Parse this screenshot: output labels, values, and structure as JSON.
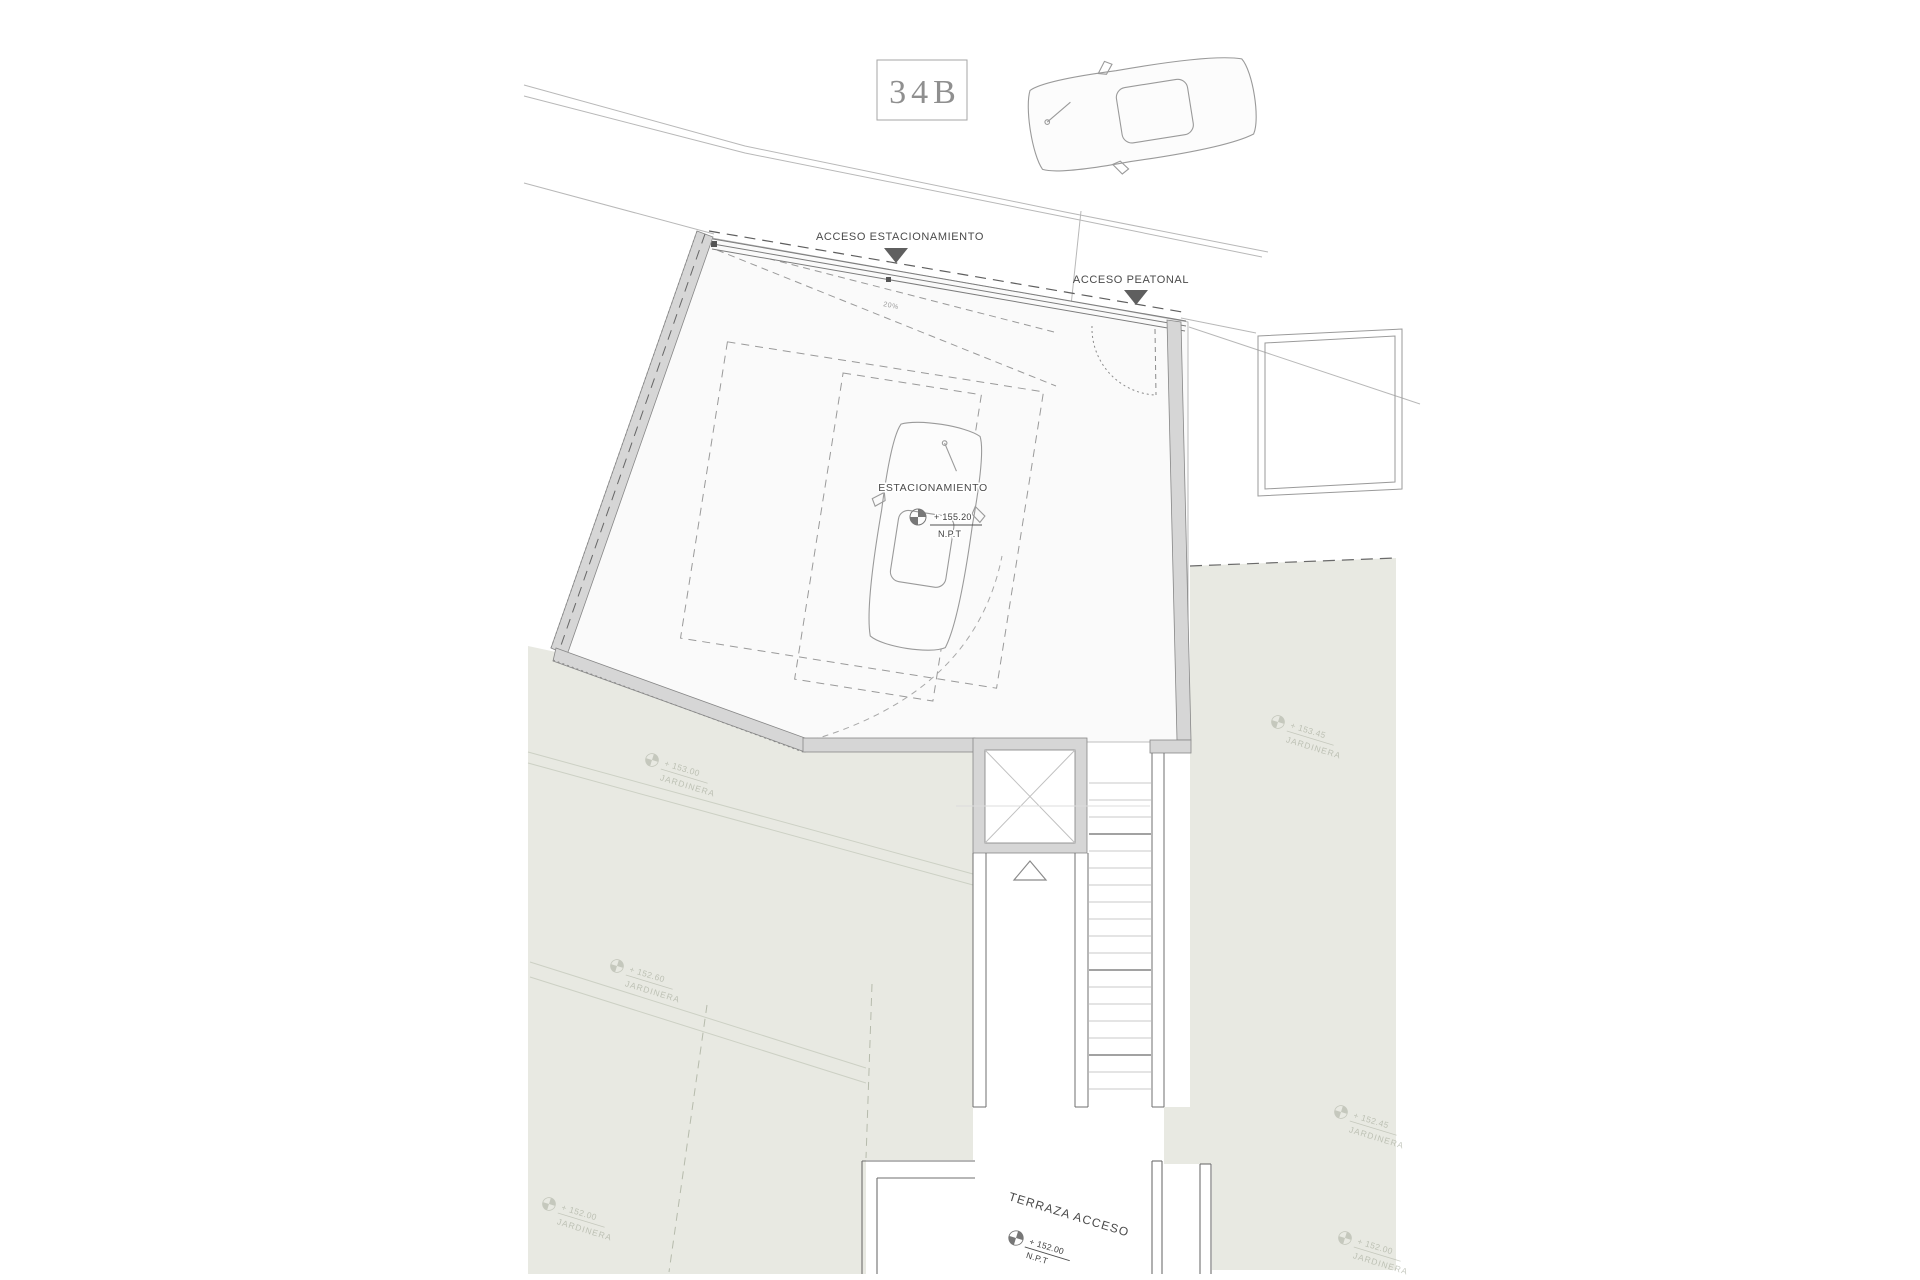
{
  "drawing": {
    "unit_label": "34B",
    "access_parking_label": "ACCESO ESTACIONAMIENTO",
    "access_pedestrian_label": "ACCESO PEATONAL",
    "ramp_slope": "20%",
    "parking": {
      "name": "ESTACIONAMIENTO",
      "level": "+ 155.20",
      "datum": "N.P.T"
    },
    "terrace": {
      "name": "TERRAZA ACCESO",
      "level": "+ 152.00",
      "datum": "N.P.T"
    },
    "planters": [
      {
        "level": "+ 153.00",
        "label": "JARDINERA"
      },
      {
        "level": "+ 152.60",
        "label": "JARDINERA"
      },
      {
        "level": "+ 152.00",
        "label": "JARDINERA"
      },
      {
        "level": "+ 153.45",
        "label": "JARDINERA"
      },
      {
        "level": "+ 152.45",
        "label": "JARDINERA"
      },
      {
        "level": "+ 152.00",
        "label": "JARDINERA"
      }
    ],
    "colors": {
      "wall_fill": "#d6d6d6",
      "planter_fill": "#e8e9e2",
      "floor_fill": "#fafafa",
      "accent_dark": "#5f5f5f",
      "line_light": "#b8b8b8"
    }
  }
}
